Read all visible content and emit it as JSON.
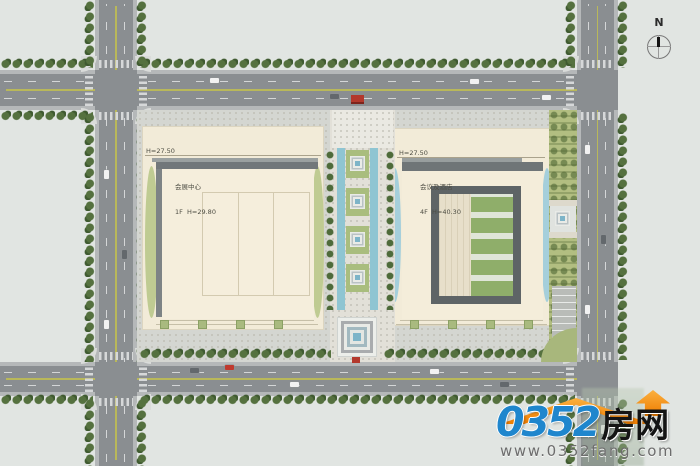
{
  "plan": {
    "compass_label": "N",
    "buildings": {
      "exhibition": {
        "platform_elevation": "H=27.50",
        "name": "会展中心",
        "spec": "1F  H=29.80"
      },
      "hotel": {
        "platform_elevation": "H=27.50",
        "name": "会议及酒店",
        "spec": "4F  H=40.30"
      }
    }
  },
  "watermark": {
    "site_number": "0352",
    "site_suffix": "房网",
    "site_url": "www.0352fang.com"
  },
  "palette": {
    "background": "#e1e5e2",
    "road": "#8a8e91",
    "sidewalk": "#b5b8b9",
    "tree_green": "#4e6b3a",
    "lawn_green": "#b2be81",
    "building_cream": "#f2ebd8",
    "shadow_gray": "#6f7577",
    "water_blue": "#8fc5d2",
    "accent_red": "#b3382c",
    "logo_blue": "#1f86cd",
    "logo_orange": "#ee7c00"
  }
}
